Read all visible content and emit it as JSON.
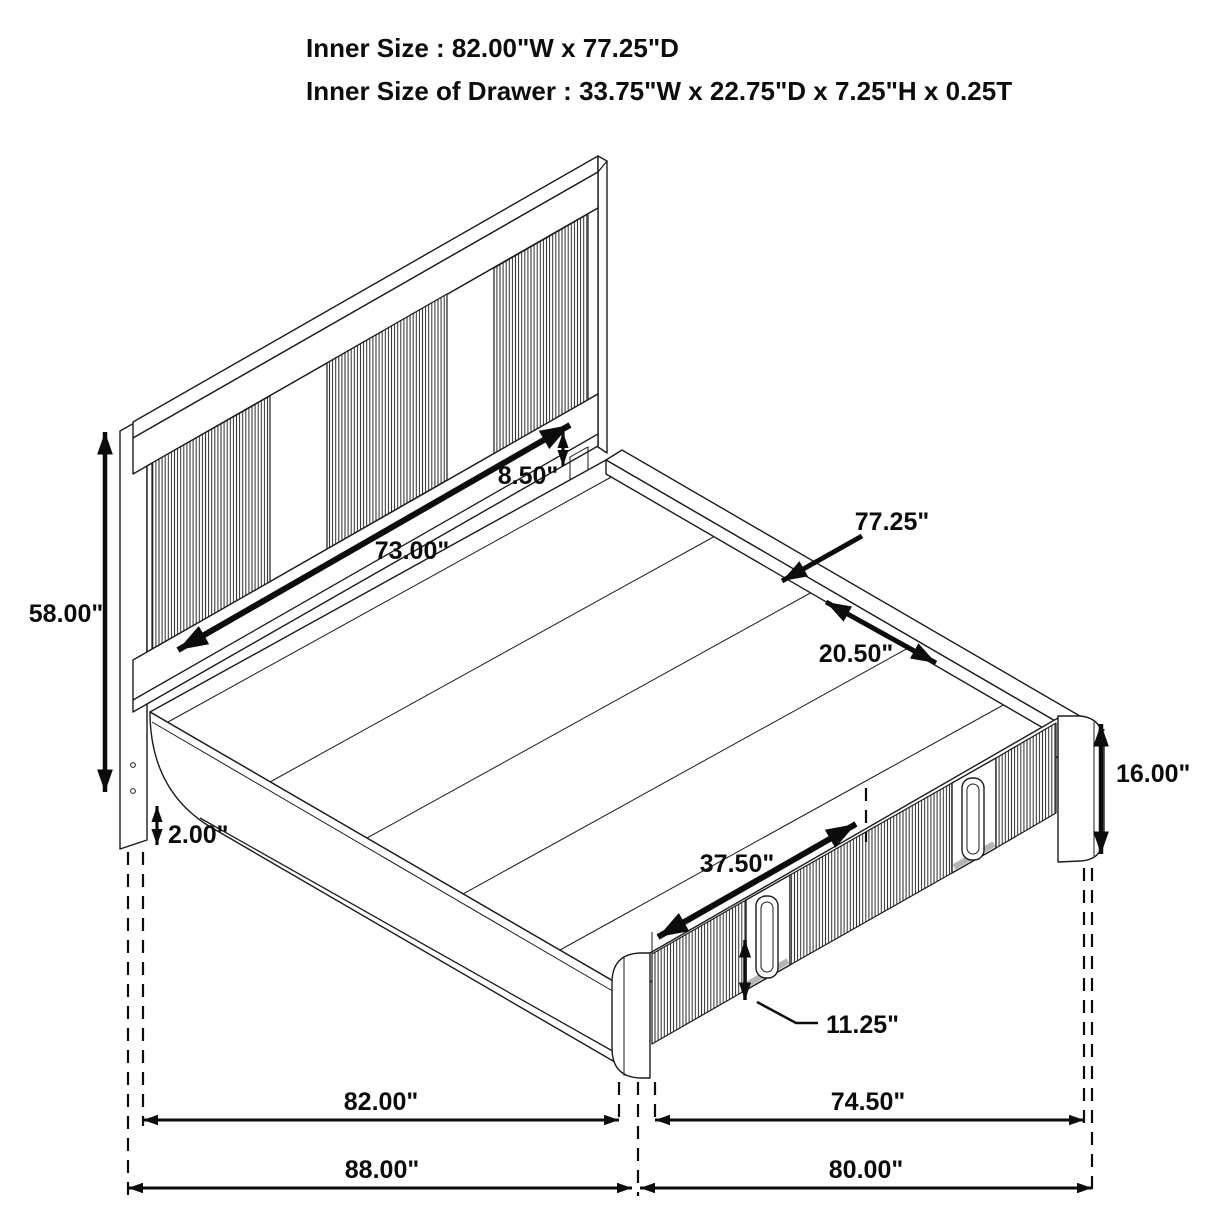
{
  "title": {
    "line1": "Inner Size : 82.00\"W x 77.25\"D",
    "line2": "Inner Size of Drawer : 33.75\"W x 22.75\"D x 7.25\"H x 0.25T"
  },
  "dimensions": {
    "headboard_height": "58.00\"",
    "rail_floor_gap": "2.00\"",
    "headboard_rail_height": "8.50\"",
    "headboard_width": "73.00\"",
    "inner_depth": "77.25\"",
    "deck_section_depth": "20.50\"",
    "footboard_height": "16.00\"",
    "drawer_front_width": "37.50\"",
    "drawer_handle_height": "11.25\"",
    "inner_width": "82.00\"",
    "footboard_width": "74.50\"",
    "overall_width": "88.00\"",
    "overall_depth": "80.00\""
  }
}
